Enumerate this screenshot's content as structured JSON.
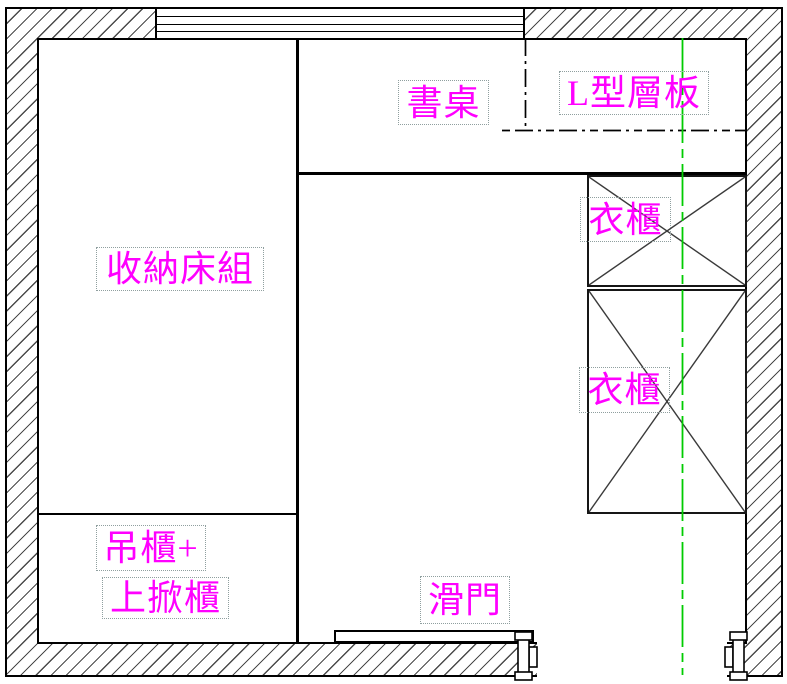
{
  "drawing_type": "interior floor plan (CAD)",
  "labels": [
    {
      "name": "storage-bed",
      "text": "收納床組"
    },
    {
      "name": "hanging-cabinet",
      "text": "吊櫃+"
    },
    {
      "name": "flip-up-cabinet",
      "text": "上掀櫃"
    },
    {
      "name": "desk",
      "text": "書桌"
    },
    {
      "name": "l-shape-shelf",
      "text": "L型層板"
    },
    {
      "name": "wardrobe-upper",
      "text": "衣櫃"
    },
    {
      "name": "wardrobe-lower",
      "text": "衣櫃"
    },
    {
      "name": "sliding-door",
      "text": "滑門"
    }
  ],
  "colors": {
    "label_text": "#FF00FF",
    "centerline": "#00CC00",
    "outline": "#000000",
    "hatch": "#4a4a4a",
    "label_box_dotted": "#8f9f9f"
  },
  "linework": {
    "wall_fill": "diagonal-hatch",
    "window_segment": "4-pane horizontal lines, top wall",
    "wardrobes": "rectangles with X cross (2)",
    "l_shelf_boundary": "dash-dot",
    "vertical_centerline": "green dash-dot",
    "door_opening": "bottom wall with roller brackets both sides"
  }
}
